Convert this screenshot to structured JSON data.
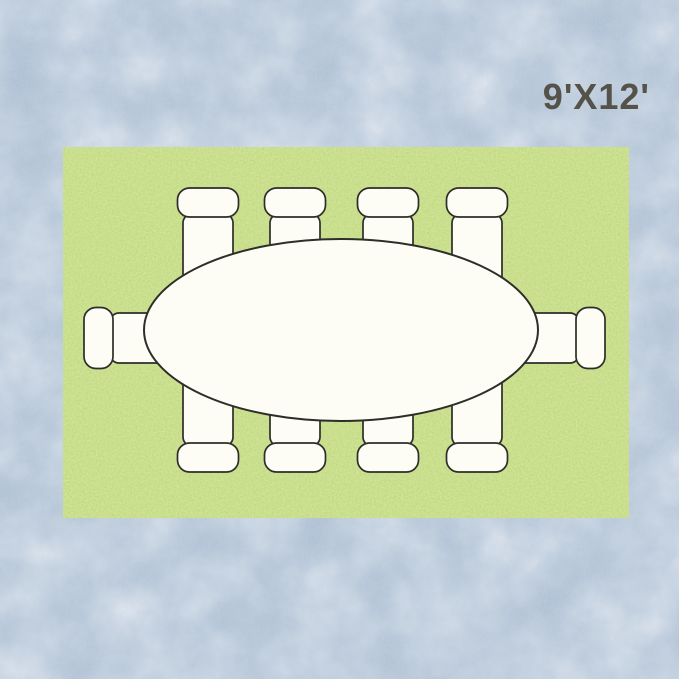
{
  "label": {
    "size_text": "9'X12'",
    "color": "#55524a"
  },
  "scene": {
    "canvas": {
      "width": 679,
      "height": 679
    },
    "colors": {
      "background_base": "#aabdd1",
      "background_clouds": "#e2e9f1",
      "background_grain": "#c9d4e2",
      "rug_base": "#c2db7f",
      "rug_speckle_light": "#e2eeb6",
      "rug_speckle_dark": "#a0c158",
      "outline": "#2d2d29",
      "furniture_fill": "#fdfdf6"
    },
    "rug": {
      "x": 63,
      "y": 147,
      "width": 566,
      "height": 371
    },
    "table": {
      "shape": "oval",
      "cx": 341,
      "cy": 330,
      "rx": 197,
      "ry": 91,
      "stroke_width": 2
    },
    "chair_geometry": {
      "seat": {
        "x": -25,
        "y": -3,
        "width": 50,
        "height": 72,
        "rx": 9
      },
      "back": {
        "x": -30.5,
        "y": -29,
        "width": 61,
        "height": 29,
        "rx": 12
      },
      "stroke_width": 1.7
    },
    "chairs": [
      {
        "side": "top",
        "cx": 208,
        "junction": 217
      },
      {
        "side": "top",
        "cx": 295,
        "junction": 217
      },
      {
        "side": "top",
        "cx": 388,
        "junction": 217
      },
      {
        "side": "top",
        "cx": 477,
        "junction": 217
      },
      {
        "side": "bottom",
        "cx": 208,
        "junction": 443
      },
      {
        "side": "bottom",
        "cx": 295,
        "junction": 443
      },
      {
        "side": "bottom",
        "cx": 388,
        "junction": 443
      },
      {
        "side": "bottom",
        "cx": 477,
        "junction": 443
      },
      {
        "side": "left",
        "cy": 338,
        "junction": 113
      },
      {
        "side": "right",
        "cy": 338,
        "junction": 576
      }
    ]
  }
}
